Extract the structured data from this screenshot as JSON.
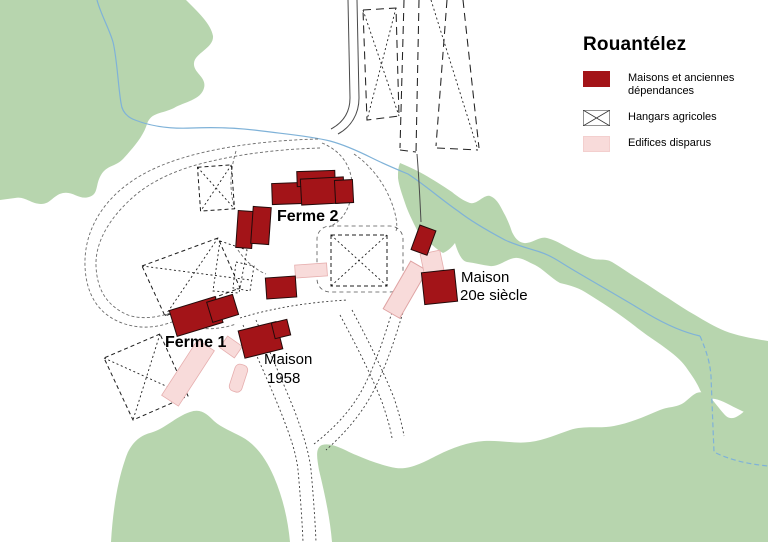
{
  "legend": {
    "title": "Rouantélez",
    "items": [
      {
        "id": "maisons",
        "line1": "Maisons et anciennes",
        "line2": "dépendances"
      },
      {
        "id": "hangars",
        "line1": "Hangars agricoles",
        "line2": ""
      },
      {
        "id": "disparus",
        "line1": "Edifices disparus",
        "line2": ""
      }
    ]
  },
  "labels": {
    "ferme2": "Ferme 2",
    "ferme1": "Ferme 1",
    "maison1958_l1": "Maison",
    "maison1958_l2": "1958",
    "maison20e_l1": "Maison",
    "maison20e_l2": "20e siècle"
  },
  "colors": {
    "building_red": "#a31418",
    "disappeared_pink": "#f8dbda",
    "disappeared_pink_stroke": "#e6aeae",
    "vegetation_green": "#b7d5ae",
    "stream_blue": "#7fb2d8",
    "line_dark": "#3c3c3c"
  }
}
